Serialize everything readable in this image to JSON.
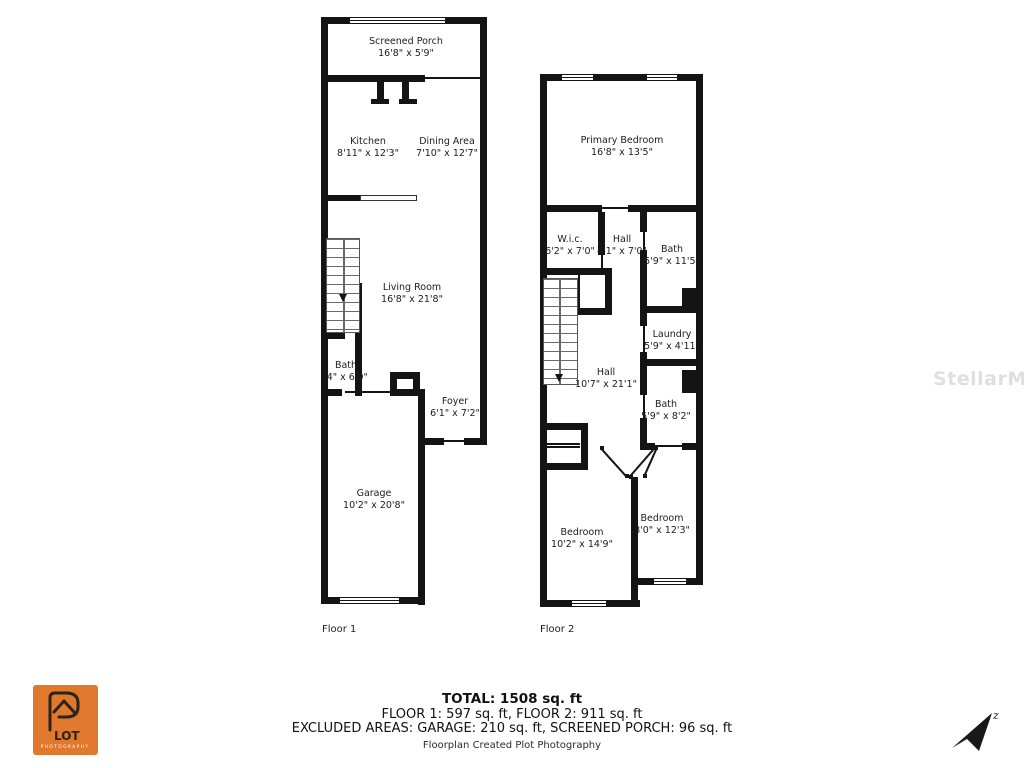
{
  "watermark": "StellarMLS",
  "floor1": {
    "label": "Floor 1",
    "rooms": {
      "screened_porch": {
        "name": "Screened Porch",
        "dims": "16'8\" x 5'9\""
      },
      "kitchen": {
        "name": "Kitchen",
        "dims": "8'11\" x 12'3\""
      },
      "dining": {
        "name": "Dining Area",
        "dims": "7'10\" x 12'7\""
      },
      "living": {
        "name": "Living Room",
        "dims": "16'8\" x 21'8\""
      },
      "bath": {
        "name": "Bath",
        "dims": "'4\" x 6'9\""
      },
      "foyer": {
        "name": "Foyer",
        "dims": "6'1\" x 7'2\""
      },
      "garage": {
        "name": "Garage",
        "dims": "10'2\" x 20'8\""
      }
    }
  },
  "floor2": {
    "label": "Floor 2",
    "rooms": {
      "primary_bedroom": {
        "name": "Primary Bedroom",
        "dims": "16'8\" x 13'5\""
      },
      "wic": {
        "name": "W.i.c.",
        "dims": "6'2\" x 7'0\""
      },
      "hall_upper": {
        "name": "Hall",
        "dims": "4'1\" x 7'0\""
      },
      "bath_upper": {
        "name": "Bath",
        "dims": "5'9\" x 11'5\""
      },
      "laundry": {
        "name": "Laundry",
        "dims": "5'9\" x 4'11\""
      },
      "hall": {
        "name": "Hall",
        "dims": "10'7\" x 21'1\""
      },
      "bath_lower": {
        "name": "Bath",
        "dims": "5'9\" x 8'2\""
      },
      "bedroom_left": {
        "name": "Bedroom",
        "dims": "10'2\" x 14'9\""
      },
      "bedroom_right": {
        "name": "Bedroom",
        "dims": "8'0\" x 12'3\""
      }
    }
  },
  "summary": {
    "total": "TOTAL: 1508 sq. ft",
    "floors": "FLOOR 1: 597 sq. ft, FLOOR 2: 911 sq. ft",
    "excluded": "EXCLUDED AREAS: GARAGE: 210 sq. ft, SCREENED PORCH: 96 sq. ft",
    "credit": "Floorplan Created Plot Photography"
  },
  "logo": {
    "brand": "LOT",
    "sub": "PHOTOGRAPHY",
    "color": "#E0792E"
  },
  "compass": {
    "label": "z"
  }
}
